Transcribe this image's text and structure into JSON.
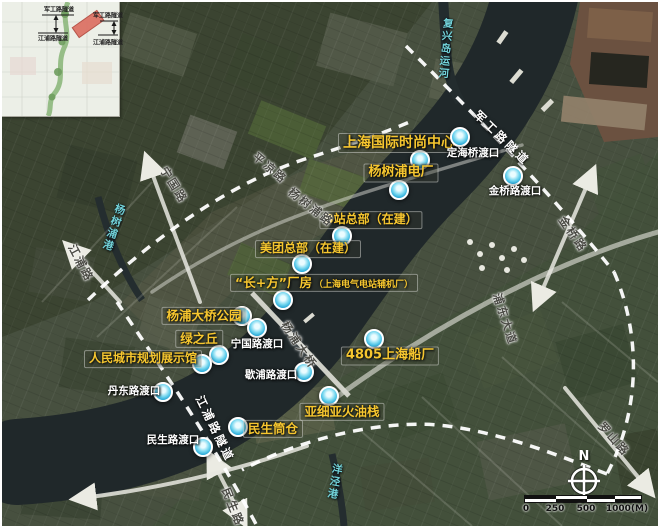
{
  "compass": {
    "label": "N"
  },
  "scalebar": {
    "ticks": [
      "0",
      "250",
      "500",
      "1000(M)"
    ]
  },
  "inset": {
    "labels": [
      {
        "text": "军工路隧道",
        "x": 57,
        "y": 7
      },
      {
        "text": "军工路隧道",
        "x": 106,
        "y": 13
      },
      {
        "text": "江浦路隧道",
        "x": 51,
        "y": 36
      },
      {
        "text": "江浦路隧道",
        "x": 106,
        "y": 40
      }
    ]
  },
  "map": {
    "pois": [
      {
        "label": "上海国际时尚中心",
        "x": 397,
        "y": 141,
        "mx": 418,
        "my": 158,
        "style": "gold",
        "fs": 14
      },
      {
        "label": "杨树浦电厂",
        "x": 399,
        "y": 171,
        "mx": 397,
        "my": 188,
        "style": "gold",
        "fs": 13
      },
      {
        "label": "B站总部（在建）",
        "x": 369,
        "y": 218,
        "mx": 340,
        "my": 234,
        "style": "gold",
        "fs": 12
      },
      {
        "label": "美团总部（在建）",
        "x": 306,
        "y": 247,
        "mx": 300,
        "my": 262,
        "style": "gold",
        "fs": 12
      },
      {
        "label": "“长+方”厂房",
        "sub": "（上海电气电站辅机厂）",
        "x": 322,
        "y": 281,
        "mx": 281,
        "my": 298,
        "style": "gold",
        "fs": 12.5
      },
      {
        "label": "杨浦大桥公园",
        "x": 202,
        "y": 314,
        "mx": 240,
        "my": 314,
        "style": "gold",
        "fs": 12.5
      },
      {
        "label": "绿之丘",
        "x": 197,
        "y": 337,
        "mx": 217,
        "my": 353,
        "style": "gold",
        "fs": 12.5
      },
      {
        "label": "人民城市规划展示馆",
        "x": 141,
        "y": 357,
        "mx": 200,
        "my": 362,
        "style": "gold",
        "fs": 12
      },
      {
        "label": "4805上海船厂",
        "x": 388,
        "y": 354,
        "mx": 372,
        "my": 337,
        "style": "gold",
        "fs": 13
      },
      {
        "label": "亚细亚火油栈",
        "x": 340,
        "y": 410,
        "mx": 327,
        "my": 394,
        "style": "gold",
        "fs": 12.5
      },
      {
        "label": "民生筒仓",
        "x": 271,
        "y": 427,
        "mx": 236,
        "my": 425,
        "style": "gold",
        "fs": 12.5
      },
      {
        "label": "定海桥渡口",
        "x": 471,
        "y": 151,
        "mx": 458,
        "my": 135,
        "style": "white"
      },
      {
        "label": "金桥路渡口",
        "x": 513,
        "y": 189,
        "mx": 511,
        "my": 174,
        "style": "white"
      },
      {
        "label": "宁国路渡口",
        "x": 255,
        "y": 342,
        "mx": 255,
        "my": 326,
        "style": "white"
      },
      {
        "label": "歇浦路渡口",
        "x": 269,
        "y": 373,
        "mx": 302,
        "my": 370,
        "style": "white"
      },
      {
        "label": "丹东路渡口",
        "x": 132,
        "y": 389,
        "mx": 161,
        "my": 390,
        "style": "white"
      },
      {
        "label": "民生路渡口",
        "x": 171,
        "y": 438,
        "mx": 201,
        "my": 445,
        "style": "white"
      }
    ],
    "road_labels": [
      {
        "label": "平凉路",
        "x": 268,
        "y": 166,
        "rot": 40
      },
      {
        "label": "宁国路",
        "x": 172,
        "y": 183,
        "rot": 58
      },
      {
        "label": "江浦路",
        "x": 79,
        "y": 261,
        "rot": 62
      },
      {
        "label": "杨树浦路",
        "x": 309,
        "y": 205,
        "rot": 38
      },
      {
        "label": "杨浦大桥",
        "x": 297,
        "y": 343,
        "rot": 56
      },
      {
        "label": "浦东大道",
        "x": 503,
        "y": 317,
        "rot": 72
      },
      {
        "label": "金桥路",
        "x": 571,
        "y": 232,
        "rot": 55
      },
      {
        "label": "民生路",
        "x": 231,
        "y": 505,
        "rot": 68
      },
      {
        "label": "罗山路",
        "x": 612,
        "y": 437,
        "rot": 48
      }
    ],
    "tunnel_labels": [
      {
        "label": "军工路隧道",
        "x": 500,
        "y": 136,
        "rot": 44
      },
      {
        "label": "江浦路隧道",
        "x": 213,
        "y": 427,
        "rot": 64
      }
    ],
    "water_labels": [
      {
        "label": "复兴岛运河",
        "x": 444,
        "y": 47,
        "rot": 5
      },
      {
        "label": "杨树浦港",
        "x": 112,
        "y": 226,
        "rot": 18
      },
      {
        "label": "洋泾港",
        "x": 333,
        "y": 480,
        "rot": 10
      }
    ]
  }
}
